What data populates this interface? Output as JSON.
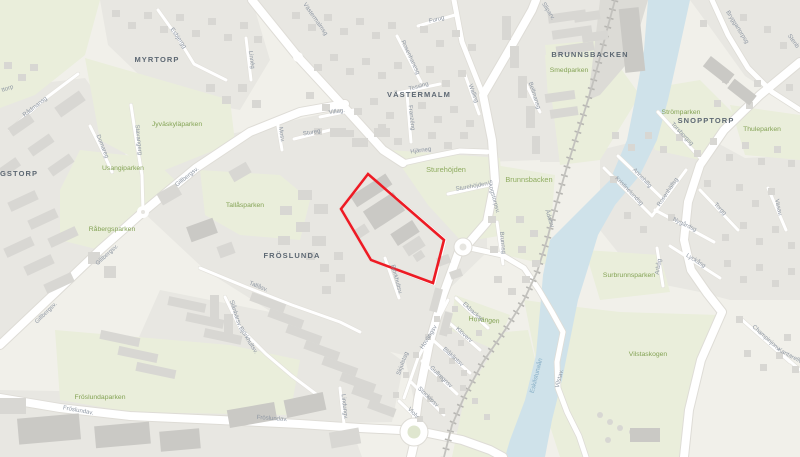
{
  "map": {
    "districts": [
      {
        "t": "MYRTORP"
      },
      {
        "t": "VÄSTERMALM"
      },
      {
        "t": "BRUNNSBACKEN"
      },
      {
        "t": "SNOPPTORP"
      },
      {
        "t": "FRÖSLUNDA"
      },
      {
        "t": "GSTORP"
      }
    ],
    "parks": [
      {
        "t": "Jyväskyläparken"
      },
      {
        "t": "Usangiparken"
      },
      {
        "t": "Tallåsparken"
      },
      {
        "t": "Råbergsparken"
      },
      {
        "t": "Fröslundaparken"
      },
      {
        "t": "Smedparken"
      },
      {
        "t": "Strömparken"
      },
      {
        "t": "Thuleparken"
      },
      {
        "t": "Surbrunnsparken"
      },
      {
        "t": "Vilstaskogen"
      },
      {
        "t": "Sturehöjden"
      },
      {
        "t": "Brunnsbacken"
      },
      {
        "t": "Hovängen"
      }
    ],
    "streets": [
      {
        "t": "Esbjergg"
      },
      {
        "t": "Linnég"
      },
      {
        "t": "Rådmansg"
      },
      {
        "t": "Domareg"
      },
      {
        "t": "Stavangerg"
      },
      {
        "t": "ttorp"
      },
      {
        "t": "Västermalmsg"
      },
      {
        "t": "Furug"
      },
      {
        "t": "Rosenhanesg"
      },
      {
        "t": "Tessing"
      },
      {
        "t": "Franzéng"
      },
      {
        "t": "Walling"
      },
      {
        "t": "Villag."
      },
      {
        "t": "Stureg"
      },
      {
        "t": "Mosv."
      },
      {
        "t": "Hjärneg"
      },
      {
        "t": "Bellmansg"
      },
      {
        "t": "Sliparv."
      },
      {
        "t": "Skogstorpsv."
      },
      {
        "t": "Sturehöjden"
      },
      {
        "t": "Brunnsg"
      },
      {
        "t": "Björkhultsv."
      },
      {
        "t": "Björkhultsv."
      },
      {
        "t": "Slånbärsv."
      },
      {
        "t": "Tallåsv."
      },
      {
        "t": "Gillbergsv."
      },
      {
        "t": "Gillbergsv."
      },
      {
        "t": "Gillbergsv."
      },
      {
        "t": "Lindungv."
      },
      {
        "t": "Fröslundav."
      },
      {
        "t": "Fröslundav."
      },
      {
        "t": "Skjulstag"
      },
      {
        "t": "Hovängsv"
      },
      {
        "t": "Klöverv"
      },
      {
        "t": "Blåklintsv"
      },
      {
        "t": "Gullregnsv"
      },
      {
        "t": "Stockrosv"
      },
      {
        "t": "Violv"
      },
      {
        "t": "Ekbacksv"
      },
      {
        "t": "Ådalsv"
      },
      {
        "t": "Annehillg"
      },
      {
        "t": "Kristinelundsg"
      },
      {
        "t": "Rosenhällsg"
      },
      {
        "t": "Torgg"
      },
      {
        "t": "Nygårdsg"
      },
      {
        "t": "Lyckåsg"
      },
      {
        "t": "Arbåg"
      },
      {
        "t": "Vasav."
      },
      {
        "t": "Torsborgsg"
      },
      {
        "t": "Bryggartorpsg"
      },
      {
        "t": "Stenb"
      },
      {
        "t": "Champinjonv"
      },
      {
        "t": "Kantarellv"
      },
      {
        "t": "Vilstav."
      }
    ],
    "water": {
      "label": "Eskilstunaån"
    },
    "highlight": {
      "shape": "polygon",
      "color": "#ed1b24"
    },
    "colors": {
      "background": "#f1f0ea",
      "urban": "#e8e7e2",
      "park": "#eaeedb",
      "building": "#d8d7d3",
      "water": "#cfe2ea",
      "road": "#ffffff",
      "railway": "#bdbcb8",
      "highlight": "#ed1b24",
      "district_text": "#5d6873",
      "park_text": "#84a355",
      "street_text": "#8e97a3",
      "water_text": "#86aec6"
    }
  }
}
